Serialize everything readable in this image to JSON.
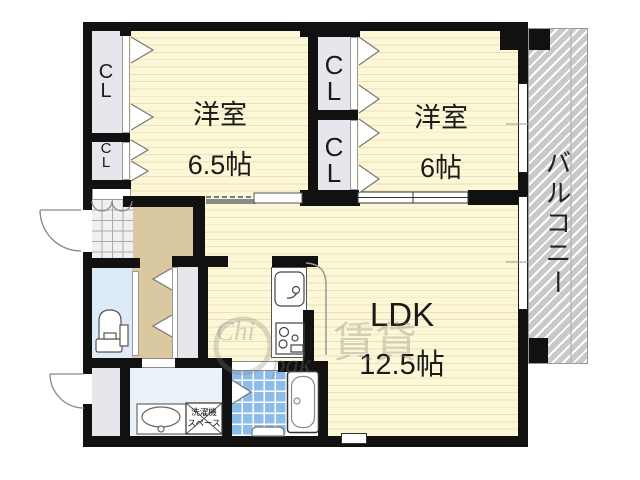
{
  "rooms": {
    "bedroom1": {
      "name": "洋室",
      "size": "6.5帖"
    },
    "bedroom2": {
      "name": "洋室",
      "size": "6帖"
    },
    "ldk": {
      "name": "LDK",
      "size": "12.5帖"
    },
    "balcony": {
      "name": "バルコニー"
    },
    "closet": {
      "label": "C\nL"
    },
    "laundry": {
      "label": "洗濯機\nスペース"
    }
  },
  "watermark": {
    "part1": "Chi",
    "part2": "賃貸",
    "part3": "pak"
  },
  "colors": {
    "wall": "#111111",
    "room_yellow": "#fcf7d6",
    "room_stripe": "#eae1b8",
    "corridor_tan": "#d9c8a0",
    "closet_gray": "#e8e6ec",
    "toilet_blue": "#ddeaf7",
    "washroom_blue": "#e9f1f9",
    "bath_tile": "#8cbce9",
    "balcony_gray": "#c9c9c9",
    "genkan_gray": "#f0f0f0"
  }
}
